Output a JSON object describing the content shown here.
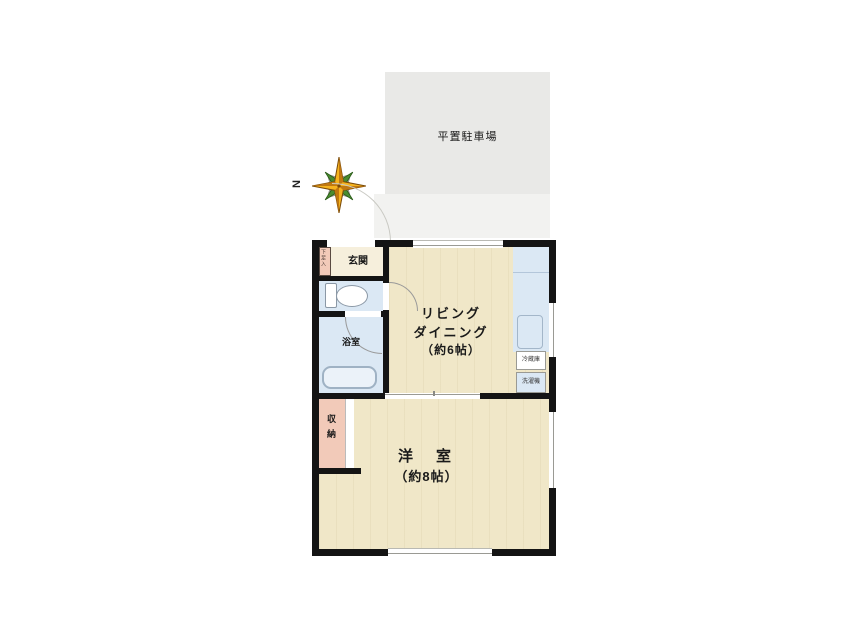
{
  "parking": {
    "label": "平置駐車場"
  },
  "compass": {
    "north_label": "N"
  },
  "rooms": {
    "genkan": {
      "label": "玄関"
    },
    "shoe_box": {
      "label": "下足入"
    },
    "bathroom": {
      "label": "浴室"
    },
    "storage": {
      "label": "収納"
    },
    "living_dining": {
      "line1": "リビング",
      "line2": "ダイニング",
      "line3": "（約6帖）"
    },
    "western_room": {
      "line1": "洋　室",
      "line2": "（約8帖）"
    },
    "refrigerator": {
      "label": "冷蔵庫"
    },
    "washer": {
      "label": "洗濯機"
    }
  },
  "colors": {
    "wall": "#141414",
    "floor_cream": "#f0e7c8",
    "entry_cream": "#f6efdc",
    "water_blue": "#dbe8f4",
    "closet_pink": "#f2cab9",
    "parking_gray": "#e9e9e7",
    "compass_gold": "#f5b31e",
    "compass_green": "#4a8c30"
  }
}
